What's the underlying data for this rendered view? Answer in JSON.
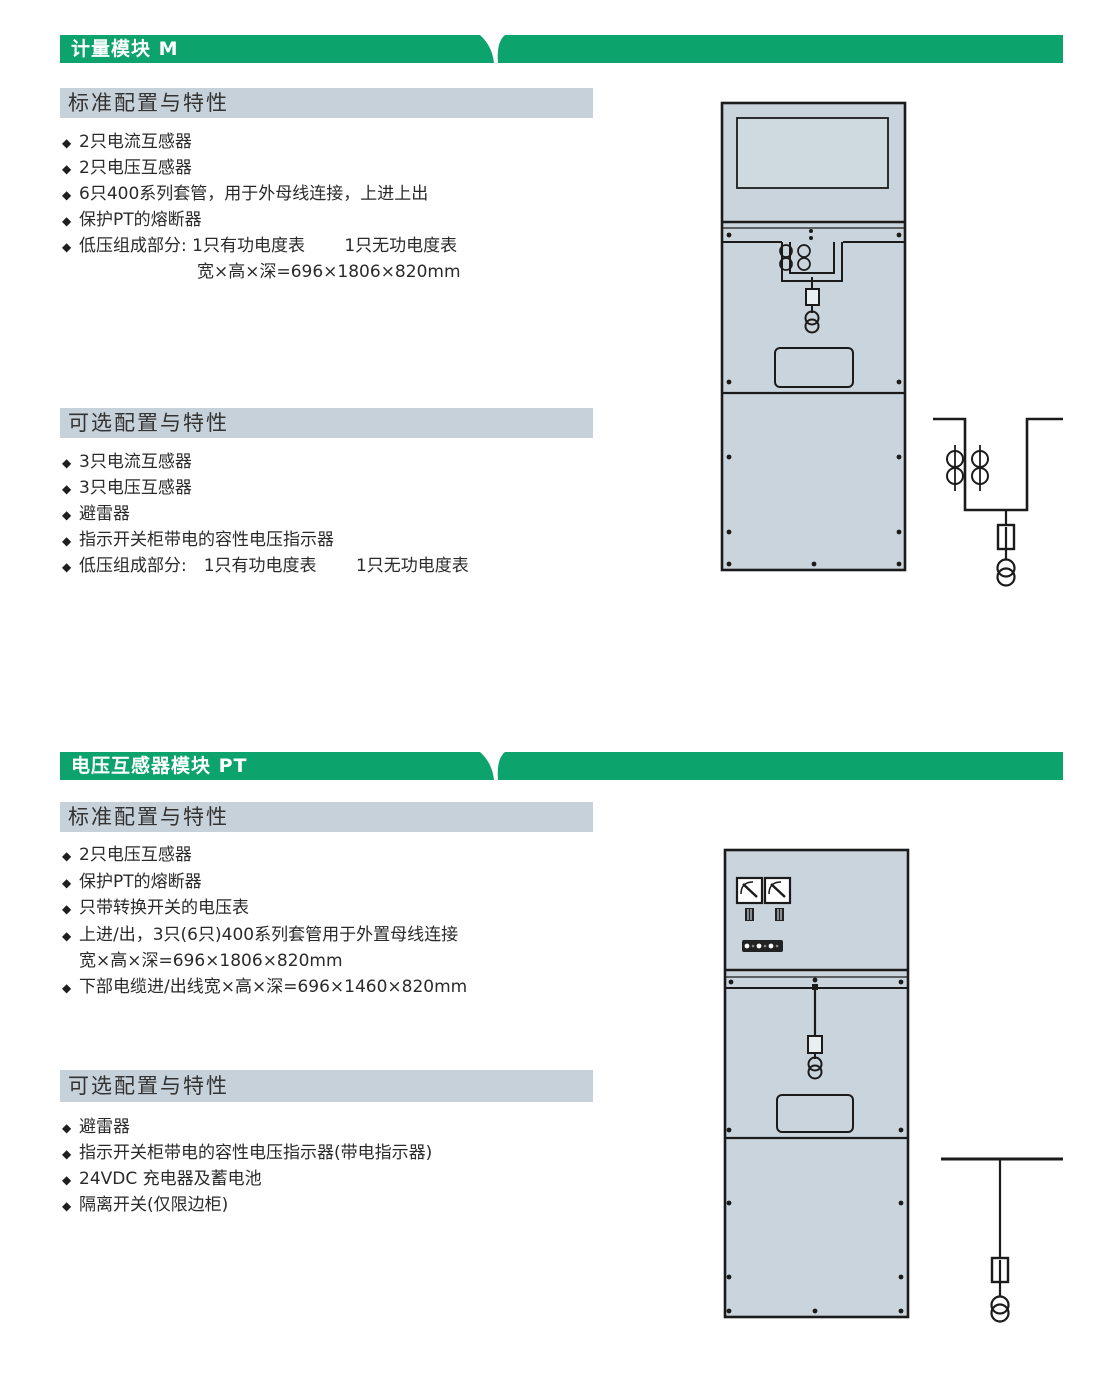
{
  "icons": {
    "bullet": "◆"
  },
  "colors": {
    "banner_green": "#0ca36c",
    "subheader_gray": "#c6d1da",
    "cabinet_fill": "#cad4dc",
    "drawing_line": "#1b1b1b",
    "text": "#2a2a2a"
  },
  "sections": [
    {
      "banner_title": "计量模块 M",
      "standard": {
        "header": "标准配置与特性",
        "items": [
          "2只电流互感器",
          "2只电压互感器",
          "6只400系列套管，用于外母线连接，上进上出",
          "保护PT的熔断器",
          "低压组成部分: 1只有功电度表　　 1只无功电度表",
          "宽×高×深=696×1806×820mm"
        ]
      },
      "optional": {
        "header": "可选配置与特性",
        "items": [
          "3只电流互感器",
          "3只电压互感器",
          "避雷器",
          "指示开关柜带电的容性电压指示器",
          "低压组成部分:　1只有功电度表　　 1只无功电度表"
        ]
      }
    },
    {
      "banner_title": "电压互感器模块 PT",
      "standard": {
        "header": "标准配置与特性",
        "items": [
          "2只电压互感器",
          "保护PT的熔断器",
          "只带转换开关的电压表",
          "上进/出，3只(6只)400系列套管用于外置母线连接",
          "宽×高×深=696×1806×820mm",
          "下部电缆进/出线宽×高×深=696×1460×820mm"
        ]
      },
      "optional": {
        "header": "可选配置与特性",
        "items": [
          "避雷器",
          "指示开关柜带电的容性电压指示器(带电指示器)",
          "24VDC 充电器及蓄电池",
          "隔离开关(仅限边柜)"
        ]
      }
    }
  ]
}
